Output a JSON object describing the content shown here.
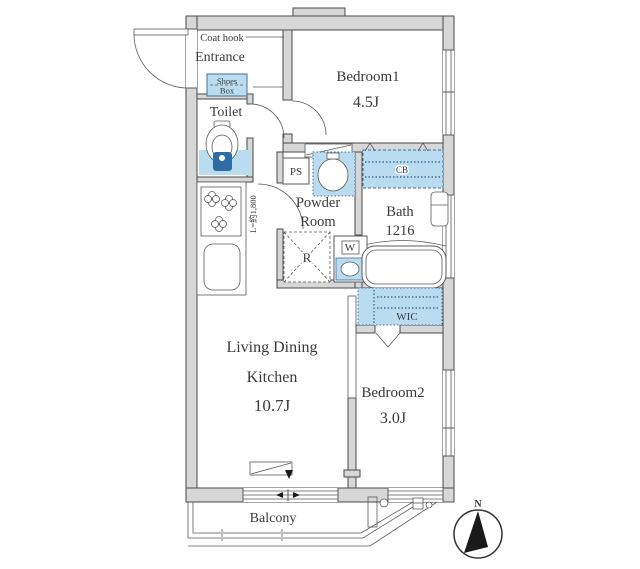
{
  "floorplan": {
    "rooms": {
      "entrance": {
        "label": "Entrance",
        "coat_hook": "Coat hook"
      },
      "shoes_box": {
        "line1": "Shoes",
        "line2": "Box"
      },
      "toilet": {
        "label": "Toilet"
      },
      "bedroom1": {
        "name": "Bedroom1",
        "size": "4.5J"
      },
      "powder_room": {
        "line1": "Powder",
        "line2": "Room"
      },
      "bath": {
        "name": "Bath",
        "size": "1216"
      },
      "ldk": {
        "line1": "Living Dining",
        "line2": "Kitchen",
        "size": "10.7J"
      },
      "bedroom2": {
        "name": "Bedroom2",
        "size": "3.0J"
      },
      "wic": {
        "label": "WIC"
      },
      "balcony": {
        "label": "Balcony"
      }
    },
    "fixtures": {
      "ps_label": "PS",
      "cb_label": "CB",
      "refrigerator_label": "R",
      "washer_label": "W",
      "kitchen_counter_length": "L=約1,800"
    },
    "compass": {
      "north_label": "N"
    },
    "colors": {
      "wall_fill": "#d7d7d7",
      "wall_stroke": "#4a4a4a",
      "line_color": "#5a5a5a",
      "text_color": "#3a3a3a",
      "fixture_blue": "#b9dcf0",
      "fixture_blue_stroke": "#41719c",
      "faucet_blue": "#2e6da4"
    }
  }
}
